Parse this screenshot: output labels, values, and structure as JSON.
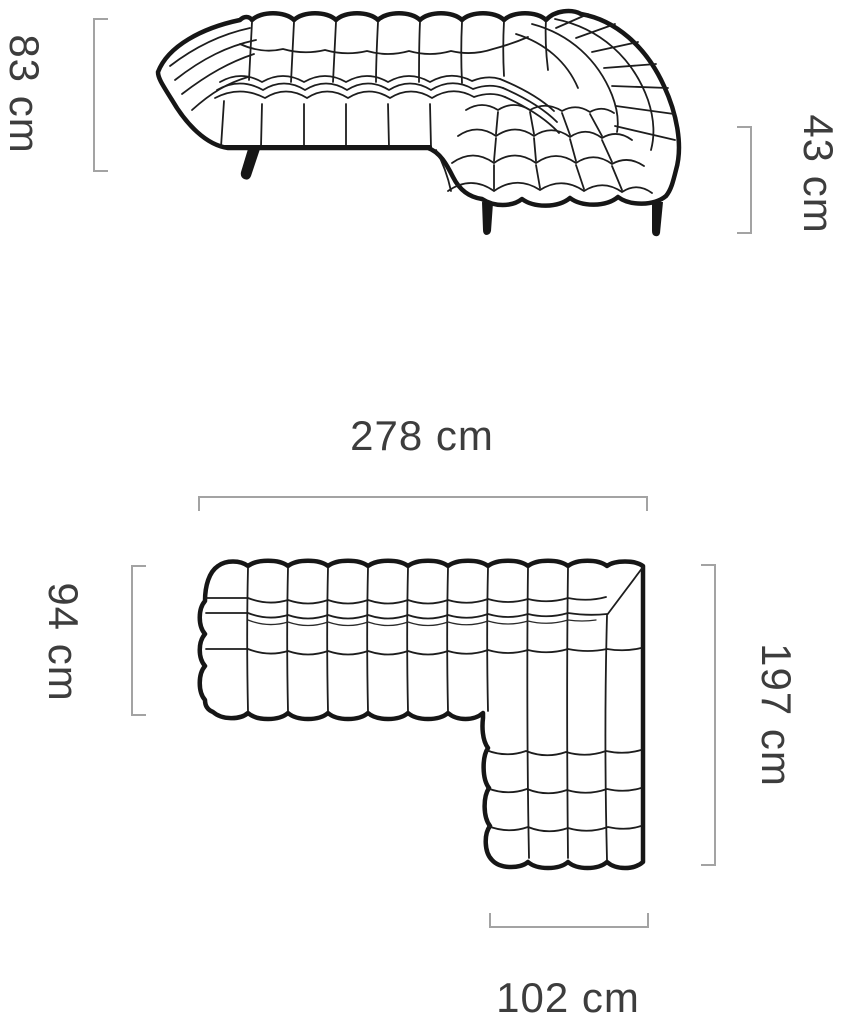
{
  "diagram": {
    "title": "Corner sofa dimensions diagram",
    "unit": "cm",
    "colors": {
      "background": "#ffffff",
      "drawing_line": "#161616",
      "dimension_line": "#a3a3a3",
      "dimension_text": "#3d3d3d"
    },
    "views": {
      "elevation": {
        "name": "front-elevation",
        "dimensions": {
          "height": {
            "label": "83 cm",
            "side": "left",
            "orientation": "vertical"
          },
          "seat_height": {
            "label": "43 cm",
            "side": "right",
            "orientation": "vertical"
          }
        }
      },
      "plan": {
        "name": "top-plan",
        "dimensions": {
          "total_width": {
            "label": "278 cm",
            "side": "top",
            "orientation": "horizontal"
          },
          "depth": {
            "label": "94 cm",
            "side": "left",
            "orientation": "vertical"
          },
          "side_length": {
            "label": "197 cm",
            "side": "right",
            "orientation": "vertical"
          },
          "chaise_width": {
            "label": "102 cm",
            "side": "bottom",
            "orientation": "horizontal"
          }
        }
      }
    }
  }
}
